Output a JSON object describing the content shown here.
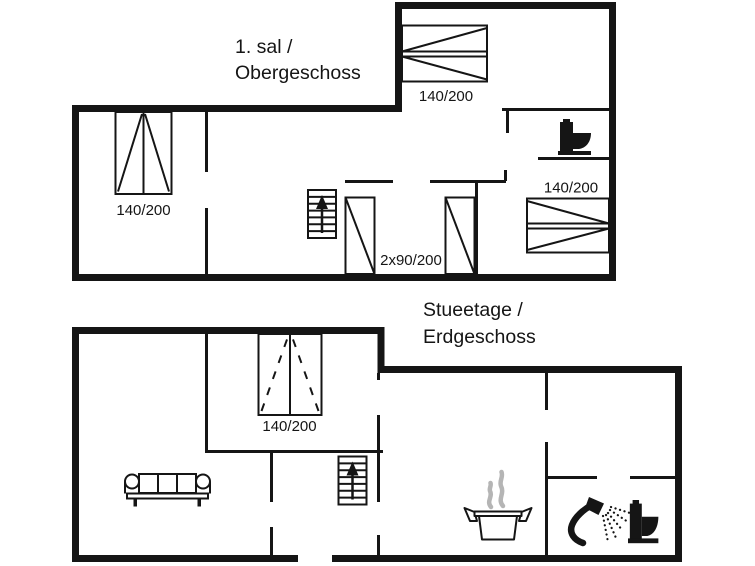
{
  "colors": {
    "ink": "#151515",
    "steam": "#b5b5b5",
    "background": "#ffffff"
  },
  "upper_floor": {
    "title_line1": "1. sal /",
    "title_line2": "Obergeschoss",
    "bed_top_label": "140/200",
    "bed_left_label": "140/200",
    "bed_right_label": "140/200",
    "beds_double_label": "2x90/200",
    "icons": [
      "toilet-icon",
      "stairs-up-icon"
    ]
  },
  "ground_floor": {
    "title_line1": "Stueetage /",
    "title_line2": "Erdgeschoss",
    "bed_label": "140/200",
    "icons": [
      "sofa-icon",
      "stairs-up-icon",
      "cooking-pot-icon",
      "steam-icon",
      "shower-icon",
      "toilet-icon"
    ]
  }
}
